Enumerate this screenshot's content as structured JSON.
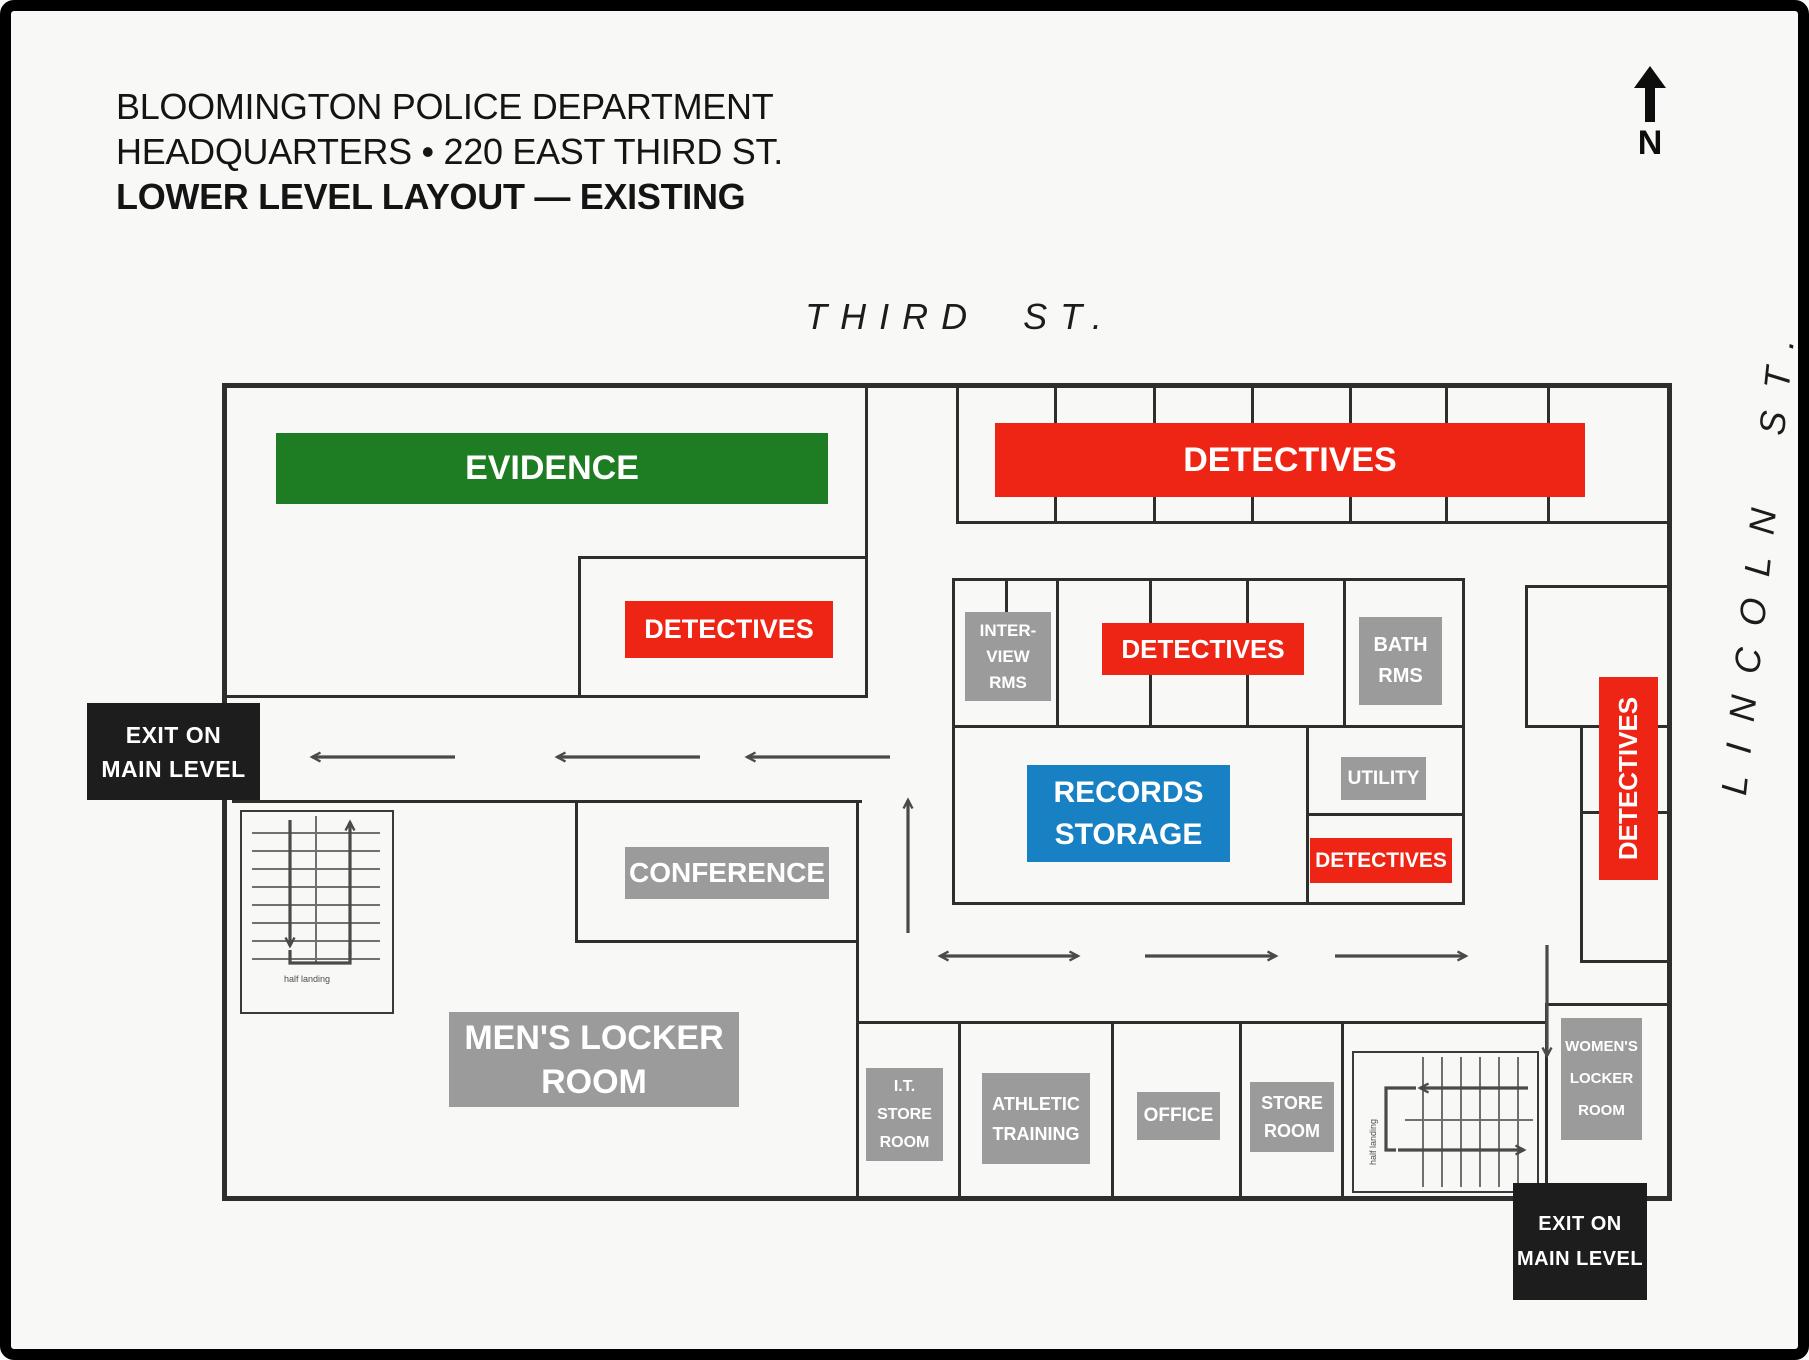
{
  "title_block": {
    "line1": "BLOOMINGTON POLICE DEPARTMENT",
    "line2": "HEADQUARTERS • 220 EAST THIRD ST.",
    "line3": "LOWER LEVEL LAYOUT — EXISTING"
  },
  "compass": {
    "label": "N"
  },
  "streets": {
    "top": "THIRD ST.",
    "right": "LINCOLN ST."
  },
  "colors": {
    "evidence_green": "#1e7d23",
    "detectives_red": "#ee2415",
    "records_blue": "#1781c3",
    "room_gray": "#9b9b9b",
    "exit_black": "#1d1d1d",
    "wall": "#2e2e2e"
  },
  "rooms": {
    "evidence": {
      "label": "EVIDENCE"
    },
    "detectives_bullpen": {
      "label": "DETECTIVES"
    },
    "detectives_west": {
      "label": "DETECTIVES"
    },
    "detectives_central": {
      "label": "DETECTIVES"
    },
    "detectives_south": {
      "label": "DETECTIVES"
    },
    "detectives_east": {
      "label": "DETECTIVES"
    },
    "interview_rooms": {
      "label": "INTER-\nVIEW\nRMS"
    },
    "bath_rooms": {
      "label": "BATH\nRMS"
    },
    "records_storage": {
      "label": "RECORDS\nSTORAGE"
    },
    "utility": {
      "label": "UTILITY"
    },
    "conference": {
      "label": "CONFERENCE"
    },
    "mens_locker_room": {
      "label": "MEN'S LOCKER\nROOM"
    },
    "it_store_room": {
      "label": "I.T.\nSTORE\nROOM"
    },
    "athletic_training": {
      "label": "ATHLETIC\nTRAINING"
    },
    "office": {
      "label": "OFFICE"
    },
    "store_room": {
      "label": "STORE\nROOM"
    },
    "womens_locker_room": {
      "label": "WOMEN'S\nLOCKER\nROOM"
    }
  },
  "exits": {
    "west": "EXIT ON\nMAIN LEVEL",
    "southeast": "EXIT ON\nMAIN LEVEL"
  },
  "stairs": {
    "west_note": "half landing",
    "east_note": "half landing"
  }
}
